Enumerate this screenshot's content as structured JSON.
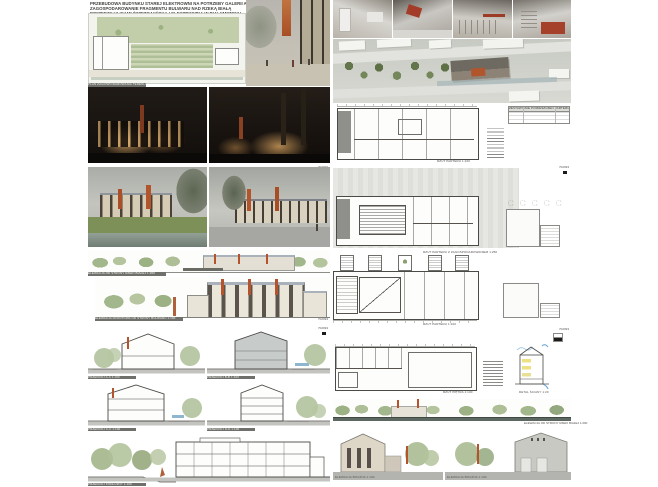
{
  "entry_number": "702093",
  "title": {
    "line1": "PRZEBUDOWA BUDYNKU STAREJ ELEKTROWNI NA POTRZEBY GALERII ARSENAŁ ORAZ",
    "line2": "ZAGOSPODAROWANIE FRAGMENTU BULWARU NAD RZEKĄ BIAŁĄ",
    "line3": "POMIĘDZY ULICAMI ŚWIĘTOJAŃSKĄ I ELEKTRYCZNĄ W BIAŁYMSTOKU"
  },
  "boards": {
    "b1": {
      "site_plan_caption": "PLAN ZAGOSPODAROWANIA TERENU 1:500"
    },
    "b2": {
      "elev_small_caption": "ELEWACJA OD STRONY RZEKI BIAŁEJ 1:200",
      "elev_large_caption": "ELEWACJA FRONTOWA OD STRONY BULWARU 1:100"
    },
    "b3": {
      "section_a": "PRZEKRÓJ A-A 1:100",
      "section_b": "PRZEKRÓJ B-B 1:100",
      "section_c": "PRZEKRÓJ C-C 1:100",
      "section_d": "PRZEKRÓJ D-D 1:100",
      "section_long": "PRZEKRÓJ PODŁUŻNY 1:100"
    },
    "r1": {
      "plan_caption": "RZUT PARTERU 1:100",
      "table_title": "ZESTAWIENIE POMIESZCZEŃ PARTERU"
    },
    "r2": {
      "plan1_caption": "RZUT PARTERU Z ZAGOSPODAROWANIEM 1:250",
      "plan2_caption": "RZUT PARTERU 1:100"
    },
    "r3": {
      "plan_caption": "RZUT PIĘTRA 1:100",
      "detail_caption": "DETAL ŚCIANY 1:20",
      "elev_river_caption": "ELEWACJA OD STRONY RZEKI BIAŁEJ 1:200",
      "elev_left_caption": "ELEWACJA BOCZNA 1:100",
      "elev_right_caption": "ELEWACJA BOCZNA 1:100"
    }
  },
  "colors": {
    "accent_orange": "#b5542c",
    "line": "#4a4a46",
    "tree_green": "#a3b78c",
    "roof_blue_gray": "#a9b2ba",
    "night": "#16110d"
  }
}
